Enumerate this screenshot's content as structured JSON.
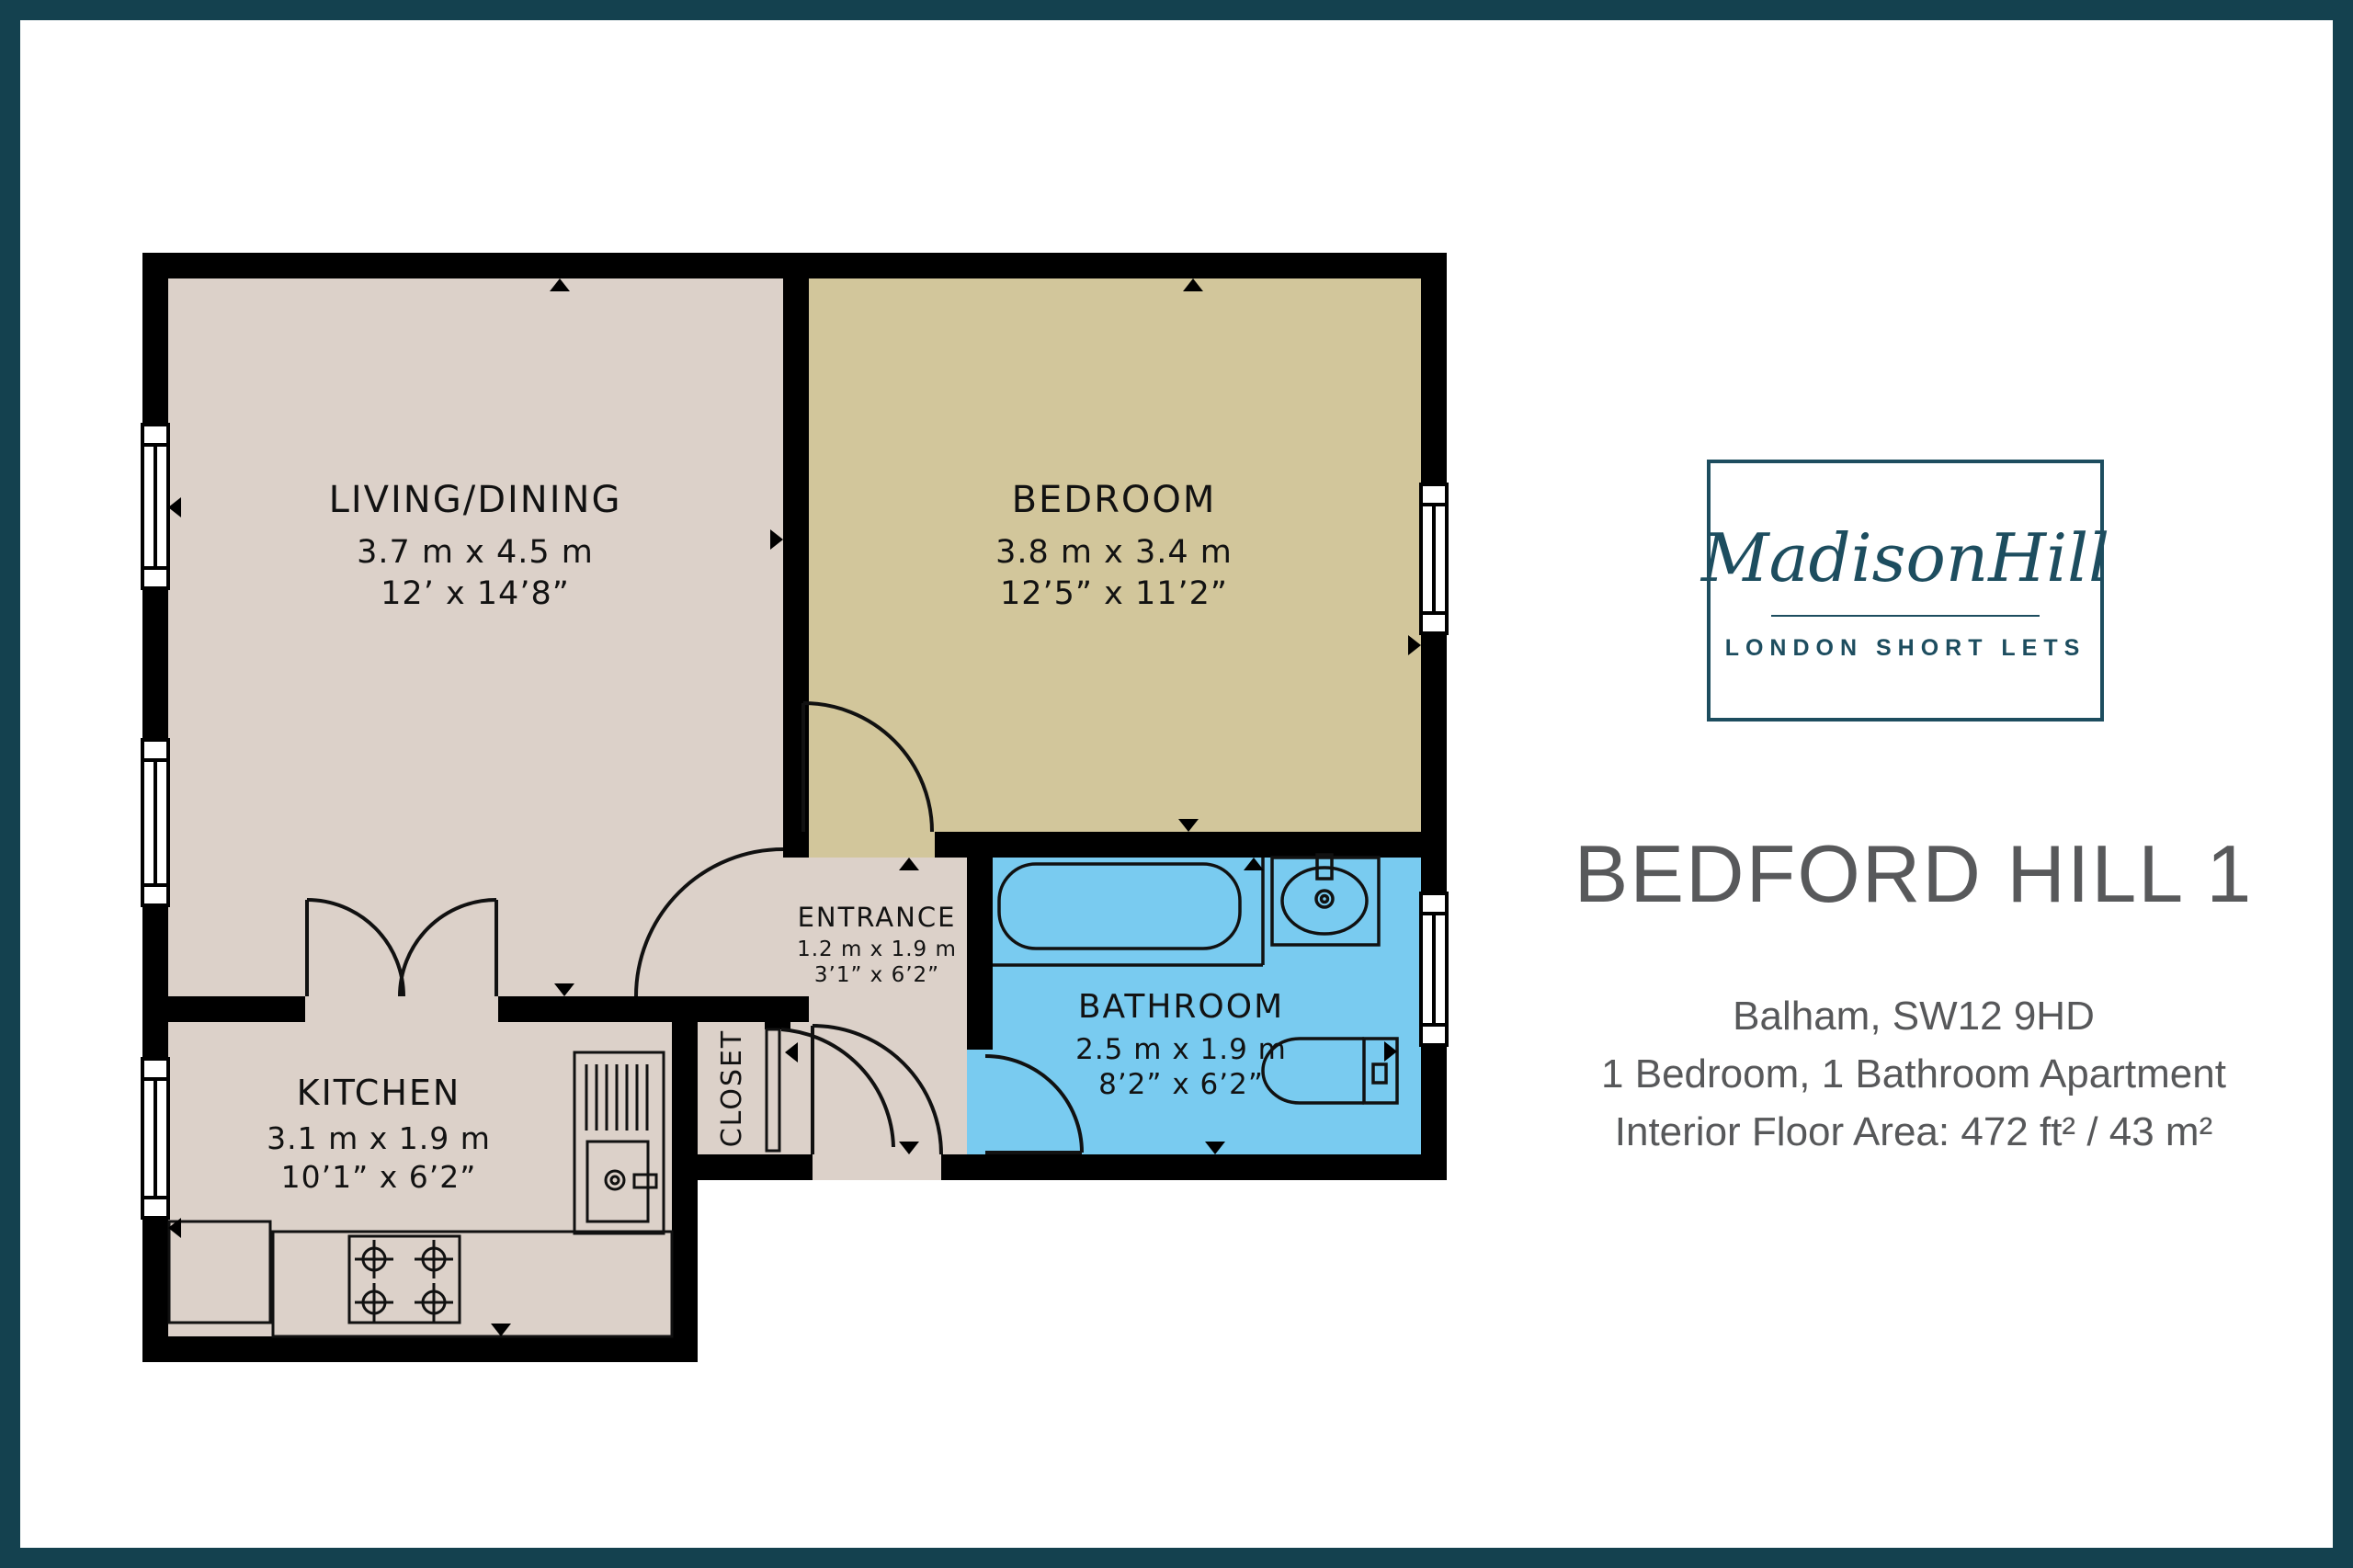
{
  "page": {
    "frame_color": "#14414f",
    "background": "#ffffff"
  },
  "floorplan": {
    "colors": {
      "wall": "#000000",
      "floor_beige": "#dcd1c9",
      "floor_khaki": "#d2c69b",
      "floor_blue": "#79cbf0"
    },
    "rooms": [
      {
        "name": "LIVING/DINING",
        "metric": "3.7 m x 4.5 m",
        "imperial": "12’ x 14’8”"
      },
      {
        "name": "BEDROOM",
        "metric": "3.8 m x 3.4 m",
        "imperial": "12’5” x 11’2”"
      },
      {
        "name": "KITCHEN",
        "metric": "3.1 m x 1.9 m",
        "imperial": "10’1” x 6’2”"
      },
      {
        "name": "ENTRANCE",
        "metric": "1.2 m x 1.9 m",
        "imperial": "3’1” x 6’2”"
      },
      {
        "name": "BATHROOM",
        "metric": "2.5 m x 1.9 m",
        "imperial": "8’2” x 6’2”"
      },
      {
        "name": "CLOSET"
      }
    ]
  },
  "sidebar": {
    "logo": {
      "brand": "MadisonHill",
      "tagline": "LONDON SHORT LETS",
      "color": "#1d4d5f"
    },
    "title": "BEDFORD HILL 1",
    "address_line": "Balham, SW12 9HD",
    "summary_line": "1 Bedroom, 1 Bathroom Apartment",
    "area_line": "Interior Floor Area: 472 ft² / 43 m²"
  }
}
